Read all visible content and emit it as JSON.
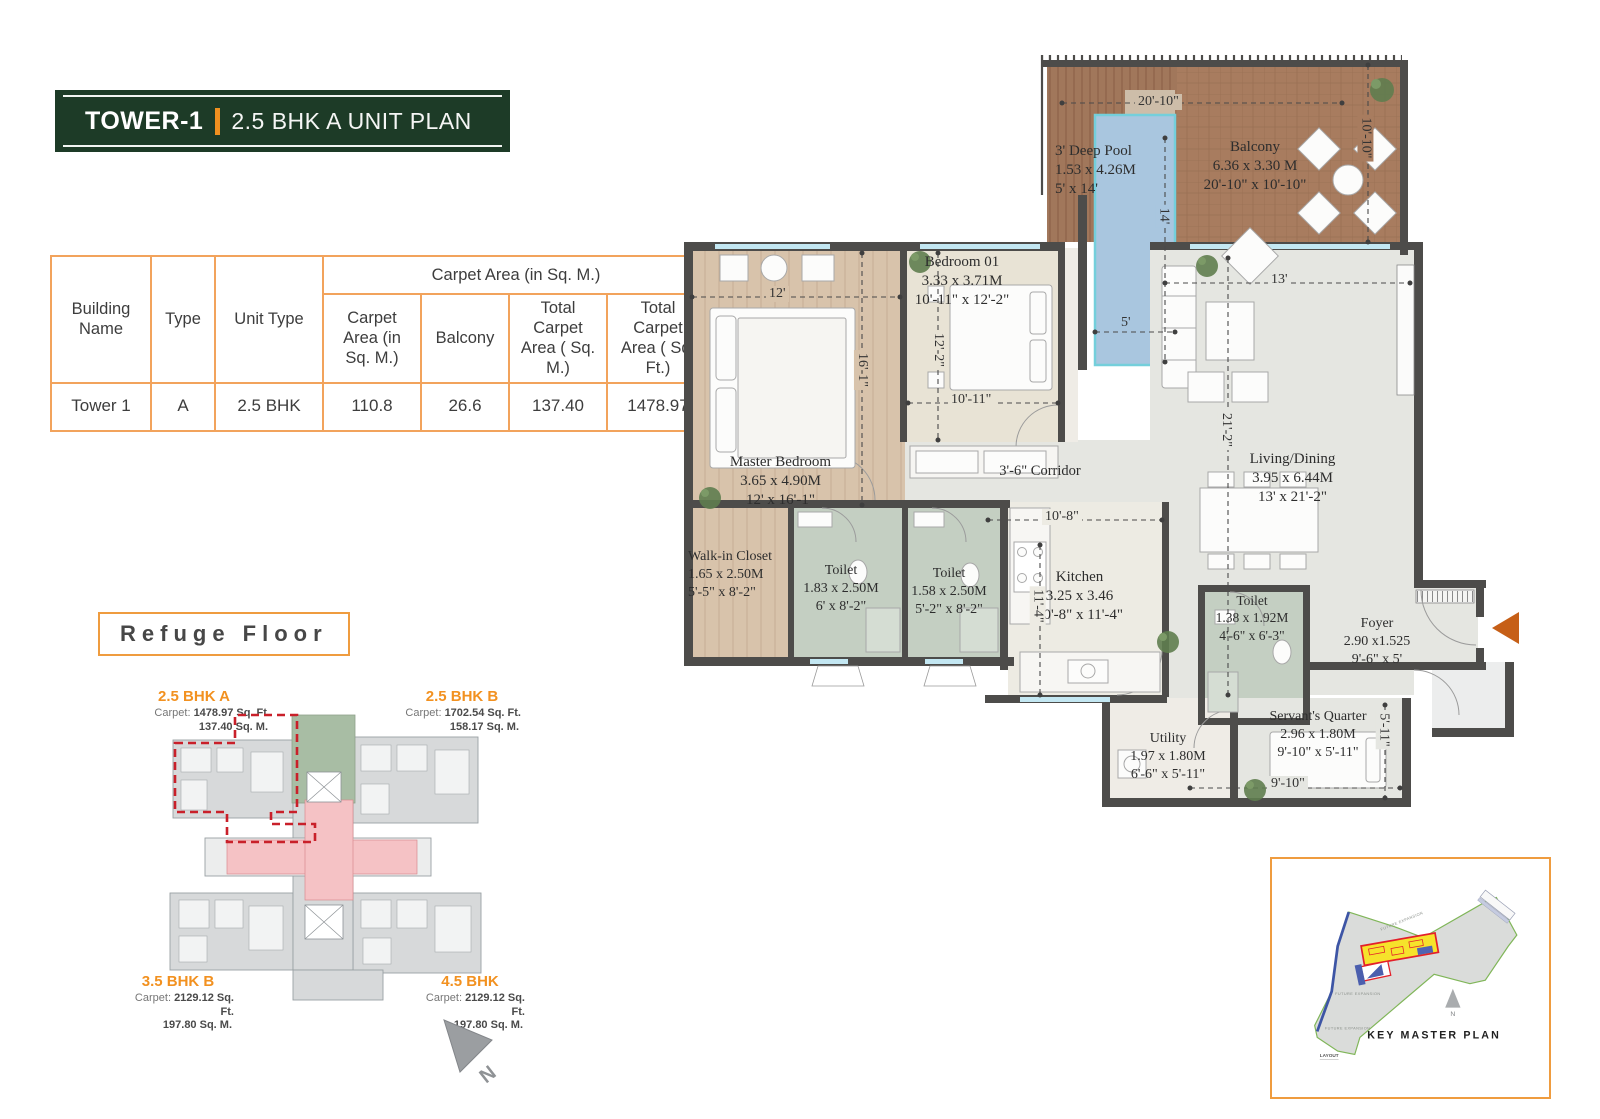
{
  "title": {
    "tower": "TOWER-1",
    "plan": "2.5 BHK A UNIT PLAN"
  },
  "table": {
    "group_header": "Carpet Area (in Sq. M.)",
    "col_building": "Building Name",
    "col_type": "Type",
    "col_unit": "Unit Type",
    "col_carpet": "Carpet Area (in Sq. M.)",
    "col_balcony": "Balcony",
    "col_total_m": "Total Carpet Area ( Sq. M.)",
    "col_total_ft": "Total Carpet Area ( Sq. Ft.)",
    "row": {
      "building": "Tower 1",
      "type": "A",
      "unit": "2.5 BHK",
      "carpet": "110.8",
      "balcony": "26.6",
      "total_m": "137.40",
      "total_ft": "1478.97"
    }
  },
  "refuge": {
    "heading": "Refuge Floor",
    "carpet_label": "Carpet:",
    "units": {
      "a": {
        "name": "2.5 BHK A",
        "sqft": "1478.97 Sq. Ft.",
        "sqm": "137.40 Sq. M."
      },
      "b": {
        "name": "2.5 BHK B",
        "sqft": "1702.54 Sq. Ft.",
        "sqm": "158.17 Sq. M."
      },
      "c": {
        "name": "3.5 BHK B",
        "sqft": "2129.12 Sq. Ft.",
        "sqm": "197.80 Sq. M."
      },
      "d": {
        "name": "4.5 BHK",
        "sqft": "2129.12 Sq. Ft.",
        "sqm": "197.80 Sq. M."
      }
    },
    "north": "N"
  },
  "floorplan": {
    "rooms": {
      "pool": {
        "name": "3' Deep Pool",
        "metric": "1.53 x 4.26M",
        "imperial": "5' x 14'"
      },
      "balcony": {
        "name": "Balcony",
        "metric": "6.36 x 3.30 M",
        "imperial": "20'-10\" x 10'-10\""
      },
      "bedroom1": {
        "name": "Bedroom 01",
        "metric": "3.33 x 3.71M",
        "imperial": "10'-11\" x 12'-2\""
      },
      "master": {
        "name": "Master Bedroom",
        "metric": "3.65 x 4.90M",
        "imperial": "12' x 16'-1\""
      },
      "living": {
        "name": "Living/Dining",
        "metric": "3.95 x 6.44M",
        "imperial": "13' x 21'-2\""
      },
      "walkin": {
        "name": "Walk-in Closet",
        "metric": "1.65 x 2.50M",
        "imperial": "5'-5\" x 8'-2\""
      },
      "toilet1": {
        "name": "Toilet",
        "metric": "1.83 x 2.50M",
        "imperial": "6' x 8'-2\""
      },
      "toilet2": {
        "name": "Toilet",
        "metric": "1.58 x 2.50M",
        "imperial": "5'-2\" x 8'-2\""
      },
      "kitchen": {
        "name": "Kitchen",
        "metric": "3.25 x 3.46",
        "imperial": "10'-8\" x 11'-4\""
      },
      "toilet3": {
        "name": "Toilet",
        "metric": "1.38 x 1.92M",
        "imperial": "4'-6\" x 6'-3\""
      },
      "foyer": {
        "name": "Foyer",
        "metric": "2.90 x1.525",
        "imperial": "9'-6\" x 5'"
      },
      "utility": {
        "name": "Utility",
        "metric": "1.97 x 1.80M",
        "imperial": "6'-6\" x 5'-11\""
      },
      "servant": {
        "name": "Servant's Quarter",
        "metric": "2.96 x 1.80M",
        "imperial": "9'-10\" x 5'-11\""
      }
    },
    "corridor_label": "3'-6\" Corridor",
    "dims": {
      "balcony_w": "20'-10\"",
      "balcony_h": "10'-10\"",
      "pool_h": "14'",
      "pool_w": "5'",
      "master_w": "12'",
      "master_h": "16'-1\"",
      "bedroom1_h": "12'-2\"",
      "bedroom1_w": "10'-11\"",
      "living_w": "13'",
      "living_h": "21'-2\"",
      "kitchen_w": "10'-8\"",
      "kitchen_h": "11'-4\"",
      "servant_w": "9'-10\"",
      "servant_h": "5'-11\""
    }
  },
  "key_plan": {
    "title": "KEY MASTER PLAN",
    "future_expansion": "FUTURE EXPANSION",
    "layout": "LAYOUT",
    "north": "N"
  }
}
